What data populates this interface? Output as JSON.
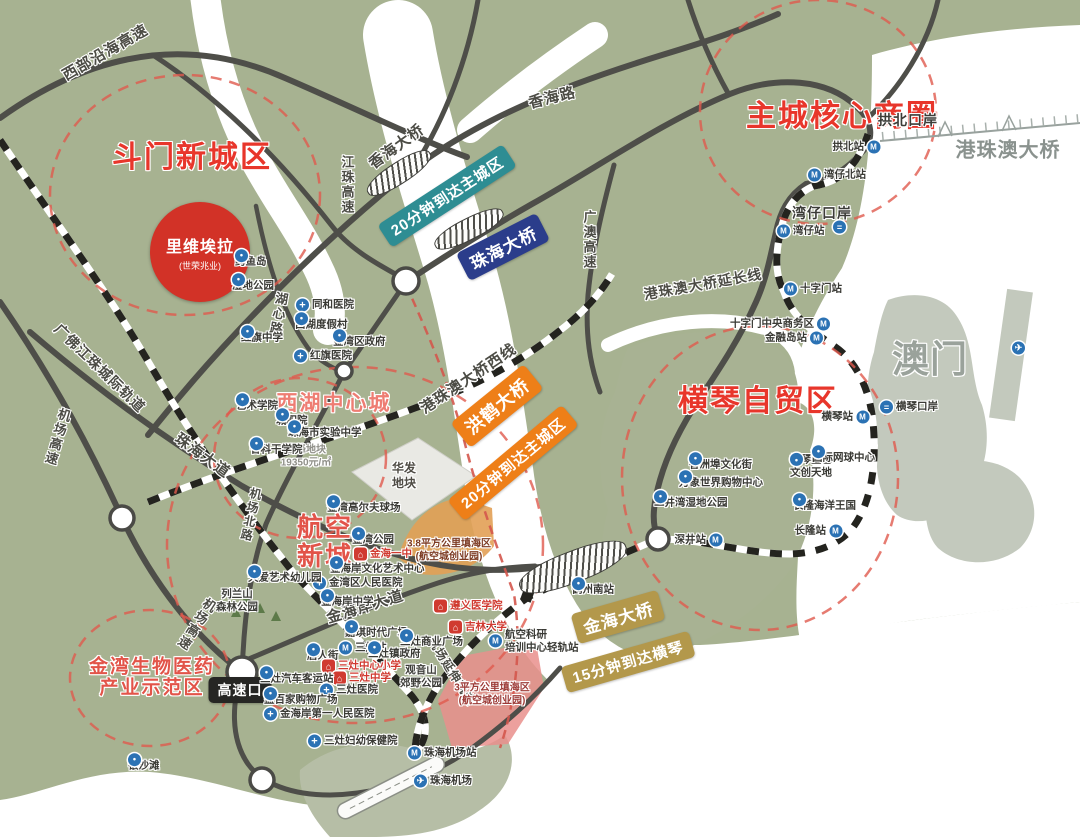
{
  "map": {
    "colors": {
      "land": "#a7b291",
      "water": "#ffffff",
      "road": "#4e4e49",
      "district_red": "#e8362b",
      "salmon_red": "#e25449",
      "badge_teal": "#2e8d93",
      "badge_navy": "#2b3d8b",
      "badge_orange": "#ee7f18",
      "badge_gold": "#b3984b",
      "badge_black": "#262624",
      "poi_blue": "#2b72b4",
      "school_red": "#d03a30",
      "macau_gray": "#c3c9bd"
    },
    "riviera": {
      "title": "里维埃拉",
      "subtitle": "(世荣兆业)"
    },
    "districts": [
      {
        "lines": [
          "斗门新城区"
        ],
        "x": 192,
        "y": 158,
        "fs": 30,
        "color": "#e8362b"
      },
      {
        "lines": [
          "主城核心商圈"
        ],
        "x": 842,
        "y": 117,
        "fs": 30,
        "color": "#e8362b"
      },
      {
        "lines": [
          "横琴自贸区"
        ],
        "x": 758,
        "y": 402,
        "fs": 30,
        "color": "#e8362b"
      },
      {
        "lines": [
          "西湖中心城"
        ],
        "x": 334,
        "y": 404,
        "fs": 21,
        "color": "#ee7d73"
      },
      {
        "lines": [
          "航空",
          "新城"
        ],
        "x": 325,
        "y": 542,
        "fs": 26,
        "color": "#e25449"
      },
      {
        "lines": [
          "金湾生物医药",
          "产业示范区"
        ],
        "x": 152,
        "y": 678,
        "fs": 19,
        "color": "#e25449"
      }
    ],
    "badges": [
      {
        "t": "20分钟到达主城区",
        "x": 447,
        "y": 196,
        "rot": -33,
        "bg": "#2e8d93",
        "fs": 15
      },
      {
        "t": "珠海大桥",
        "x": 503,
        "y": 247,
        "rot": -27,
        "bg": "#2b3d8b",
        "fs": 17
      },
      {
        "t": "洪鹤大桥",
        "x": 497,
        "y": 406,
        "rot": -39,
        "bg": "#ee7f18",
        "fs": 18
      },
      {
        "t": "20分钟到达主城区",
        "x": 513,
        "y": 463,
        "rot": -40,
        "bg": "#ee7f18",
        "fs": 15
      },
      {
        "t": "金海大桥",
        "x": 618,
        "y": 617,
        "rot": -16,
        "bg": "#b3984b",
        "fs": 17
      },
      {
        "t": "15分钟到达横琴",
        "x": 628,
        "y": 662,
        "rot": -16,
        "bg": "#b3984b",
        "fs": 15
      },
      {
        "t": "高速口",
        "x": 240,
        "y": 690,
        "rot": 0,
        "bg": "#262624",
        "fs": 14
      }
    ],
    "labels": [
      {
        "t": "西部沿海高速",
        "x": 105,
        "y": 52,
        "rot": -30,
        "fs": 15
      },
      {
        "t": "香海路",
        "x": 552,
        "y": 97,
        "rot": -14,
        "fs": 15
      },
      {
        "t": "香海大桥",
        "x": 396,
        "y": 146,
        "rot": -36,
        "fs": 15
      },
      {
        "t": "江珠高速",
        "x": 347,
        "y": 185,
        "v": true,
        "fs": 13
      },
      {
        "t": "广澳高速",
        "x": 589,
        "y": 240,
        "v": true,
        "fs": 13
      },
      {
        "t": "港珠澳大桥延长线",
        "x": 703,
        "y": 284,
        "rot": -10,
        "fs": 14
      },
      {
        "t": "港珠澳大桥",
        "x": 1008,
        "y": 148,
        "fs": 20,
        "color": "#8a928e"
      },
      {
        "t": "澳门",
        "x": 930,
        "y": 356,
        "fs": 37,
        "color": "#9aa29b"
      },
      {
        "t": "港珠澳大桥西线",
        "x": 468,
        "y": 378,
        "rot": -34,
        "fs": 15
      },
      {
        "t": "湖心路",
        "x": 278,
        "y": 314,
        "v": true,
        "rot": 10,
        "fs": 13
      },
      {
        "t": "机场北路",
        "x": 251,
        "y": 515,
        "v": true,
        "rot": 12,
        "fs": 12
      },
      {
        "t": "珠海大道",
        "x": 203,
        "y": 455,
        "rot": 36,
        "fs": 15
      },
      {
        "t": "机场高速",
        "x": 57,
        "y": 437,
        "v": true,
        "rot": 16,
        "fs": 13
      },
      {
        "t": "机场高速",
        "x": 196,
        "y": 624,
        "v": true,
        "rot": 33,
        "fs": 13
      },
      {
        "t": "广佛江珠城际轨道",
        "x": 100,
        "y": 368,
        "rot": 44,
        "fs": 14
      },
      {
        "t": "金海岸大道",
        "x": 365,
        "y": 606,
        "rot": -17,
        "fs": 15
      },
      {
        "t": "机场延伸轨道",
        "x": 452,
        "y": 671,
        "rot": 58,
        "fs": 12
      },
      {
        "t": "拱北口岸",
        "x": 908,
        "y": 120,
        "fs": 14,
        "color": "#3c3c38"
      },
      {
        "t": "湾仔口岸",
        "x": 822,
        "y": 213,
        "fs": 14,
        "color": "#3c3c38"
      }
    ],
    "areas": [
      {
        "lines": [
          "旗峰地块",
          "19350元/㎡"
        ],
        "x": 306,
        "y": 457,
        "fs": 10,
        "color": "#8f8f88"
      },
      {
        "lines": [
          "华发",
          "地块"
        ],
        "x": 404,
        "y": 476,
        "fs": 12,
        "color": "#4f4c45"
      },
      {
        "lines": [
          "列兰山",
          "森林公园"
        ],
        "x": 237,
        "y": 601,
        "fs": 10.5,
        "color": "#3c3c38"
      },
      {
        "lines": [
          "观音山",
          "郊野公园"
        ],
        "x": 421,
        "y": 677,
        "fs": 10.5,
        "color": "#3c3c38"
      },
      {
        "lines": [
          "3.8平方公里填海区",
          "(航空城创业园)"
        ],
        "x": 449,
        "y": 551,
        "fs": 10,
        "color": "#7c3a22"
      },
      {
        "lines": [
          "3平方公里填海区",
          "(航空城创业园)"
        ],
        "x": 492,
        "y": 695,
        "fs": 10,
        "color": "#9c3a36"
      }
    ],
    "pois": [
      {
        "x": 235,
        "y": 262,
        "icon": "poi",
        "t": "鳄鱼岛"
      },
      {
        "x": 232,
        "y": 286,
        "icon": "poi",
        "t": "湿地公园"
      },
      {
        "x": 296,
        "y": 305,
        "icon": "hospital",
        "t": "同和医院"
      },
      {
        "x": 295,
        "y": 325,
        "icon": "poi",
        "t": "西湖度假村"
      },
      {
        "x": 333,
        "y": 342,
        "icon": "poi",
        "t": "金湾区政府"
      },
      {
        "x": 294,
        "y": 356,
        "icon": "hospital",
        "t": "红旗医院"
      },
      {
        "x": 241,
        "y": 338,
        "icon": "poi",
        "t": "红旗中学"
      },
      {
        "x": 236,
        "y": 406,
        "icon": "poi",
        "t": "艺术学院"
      },
      {
        "x": 276,
        "y": 421,
        "icon": "poi",
        "t": "城职院"
      },
      {
        "x": 288,
        "y": 433,
        "icon": "poi",
        "t": "珠海市实验中学"
      },
      {
        "x": 250,
        "y": 450,
        "icon": "poi",
        "t": "省科干学院"
      },
      {
        "x": 327,
        "y": 508,
        "icon": "poi",
        "t": "金湾高尔夫球场"
      },
      {
        "x": 352,
        "y": 540,
        "icon": "poi",
        "t": "金湾公园"
      },
      {
        "x": 354,
        "y": 554,
        "icon": "school",
        "t": "金海一中",
        "red": true
      },
      {
        "x": 330,
        "y": 569,
        "icon": "poi",
        "t": "金海岸文化艺术中心"
      },
      {
        "x": 313,
        "y": 583,
        "icon": "hospital",
        "t": "金湾区人民医院"
      },
      {
        "x": 321,
        "y": 602,
        "icon": "poi",
        "t": "金海岸中学"
      },
      {
        "x": 248,
        "y": 578,
        "icon": "poi",
        "t": "天爱艺术幼儿园"
      },
      {
        "x": 345,
        "y": 633,
        "icon": "poi",
        "t": "嘉琪时代广场"
      },
      {
        "x": 339,
        "y": 648,
        "icon": "metro",
        "t": "三灶站"
      },
      {
        "x": 307,
        "y": 656,
        "icon": "poi",
        "t": "唐人街"
      },
      {
        "x": 368,
        "y": 654,
        "icon": "poi",
        "t": "三灶镇政府"
      },
      {
        "x": 400,
        "y": 642,
        "icon": "poi",
        "t": "三灶商业广场"
      },
      {
        "x": 322,
        "y": 666,
        "icon": "school",
        "t": "三灶中心小学",
        "red": true
      },
      {
        "x": 333,
        "y": 678,
        "icon": "school",
        "t": "三灶中学",
        "red": true
      },
      {
        "x": 260,
        "y": 679,
        "icon": "poi",
        "t": "三灶汽车客运站"
      },
      {
        "x": 320,
        "y": 690,
        "icon": "hospital",
        "t": "三灶医院"
      },
      {
        "x": 264,
        "y": 700,
        "icon": "poi",
        "t": "益百家购物广场"
      },
      {
        "x": 264,
        "y": 714,
        "icon": "hospital",
        "t": "金海岸第一人民医院"
      },
      {
        "x": 308,
        "y": 741,
        "icon": "hospital",
        "t": "三灶妇幼保健院"
      },
      {
        "x": 128,
        "y": 766,
        "icon": "poi",
        "t": "银沙滩"
      },
      {
        "x": 408,
        "y": 753,
        "icon": "metro",
        "t": "珠海机场站"
      },
      {
        "x": 414,
        "y": 781,
        "icon": "plane",
        "t": "珠海机场"
      },
      {
        "x": 434,
        "y": 606,
        "icon": "school",
        "t": "遵义医学院",
        "red": true
      },
      {
        "x": 449,
        "y": 627,
        "icon": "school",
        "t": "吉林大学",
        "red": true
      },
      {
        "x": 489,
        "y": 641,
        "icon": "metro",
        "t": "航空科研",
        "l2": "培训中心轻轨站"
      },
      {
        "x": 572,
        "y": 590,
        "icon": "poi",
        "t": "鹤州南站"
      },
      {
        "x": 880,
        "y": 147,
        "icon": "metro",
        "t": "拱北站",
        "side": "l"
      },
      {
        "x": 808,
        "y": 175,
        "icon": "metro",
        "t": "湾仔北站"
      },
      {
        "x": 833,
        "y": 227,
        "icon": "customs",
        "t": ""
      },
      {
        "x": 777,
        "y": 231,
        "icon": "metro",
        "t": "湾仔站"
      },
      {
        "x": 784,
        "y": 289,
        "icon": "metro",
        "t": "十字门站"
      },
      {
        "x": 830,
        "y": 324,
        "icon": "metro",
        "t": "十字门中央商务区",
        "side": "l"
      },
      {
        "x": 823,
        "y": 338,
        "icon": "metro",
        "t": "金融岛站",
        "side": "l"
      },
      {
        "x": 869,
        "y": 417,
        "icon": "metro",
        "t": "横琴站",
        "side": "l"
      },
      {
        "x": 880,
        "y": 407,
        "icon": "customs",
        "t": "横琴口岸"
      },
      {
        "x": 752,
        "y": 465,
        "icon": "poi",
        "t": "香洲埠文化街",
        "side": "l"
      },
      {
        "x": 790,
        "y": 466,
        "icon": "poi",
        "t": "横琴星艺",
        "l2": "文创天地"
      },
      {
        "x": 812,
        "y": 458,
        "icon": "poi",
        "t": "国际网球中心"
      },
      {
        "x": 679,
        "y": 483,
        "icon": "poi",
        "t": "万象世界购物中心"
      },
      {
        "x": 654,
        "y": 503,
        "icon": "poi",
        "t": "二井湾湿地公园"
      },
      {
        "x": 856,
        "y": 506,
        "icon": "poi",
        "t": "长隆海洋王国",
        "side": "l"
      },
      {
        "x": 842,
        "y": 531,
        "icon": "metro",
        "t": "长隆站",
        "side": "l"
      },
      {
        "x": 722,
        "y": 540,
        "icon": "metro",
        "t": "深井站",
        "side": "l"
      },
      {
        "x": 1012,
        "y": 348,
        "icon": "plane",
        "t": ""
      }
    ]
  }
}
